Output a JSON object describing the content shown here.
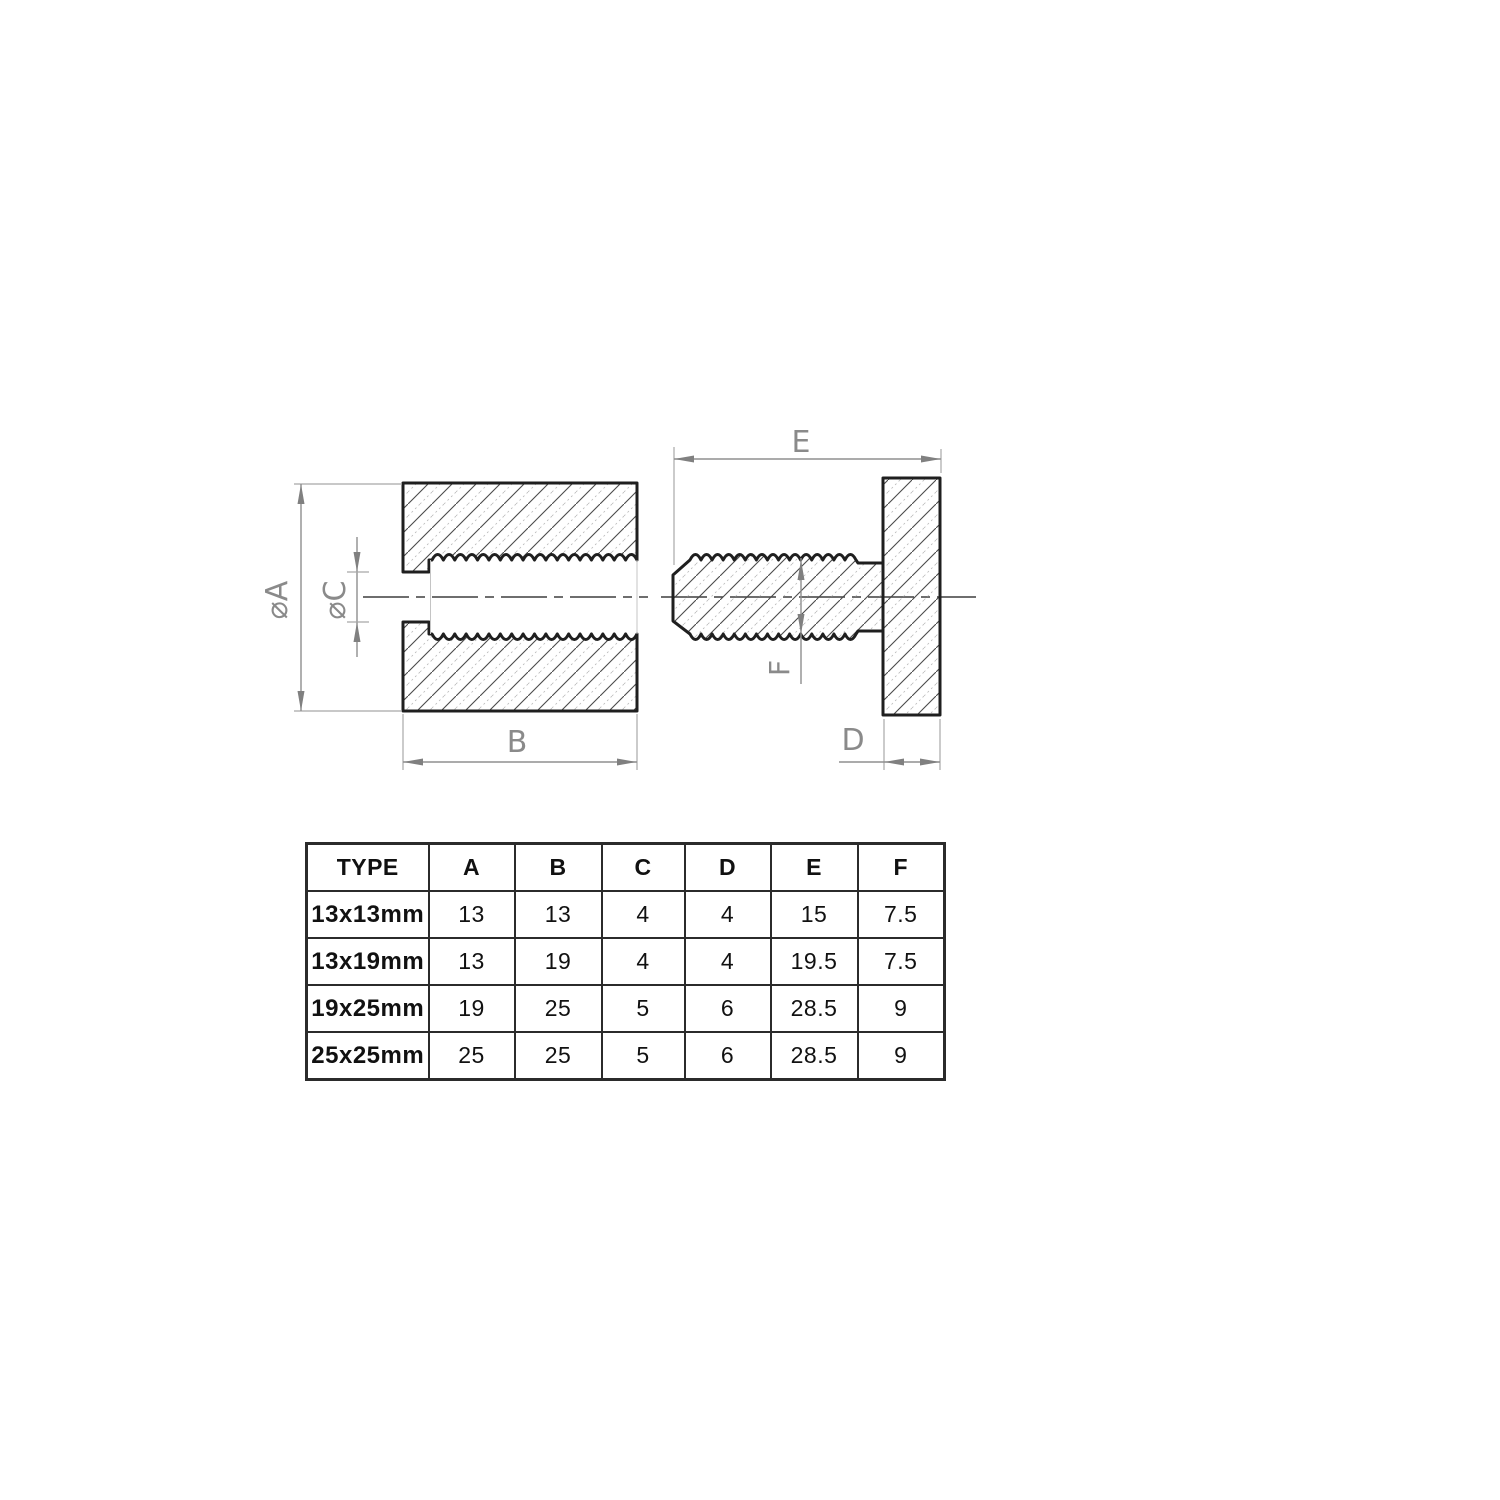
{
  "drawing": {
    "title": "threaded-sleeve-and-screw-section-drawing",
    "labels": {
      "phi_a": "⌀A",
      "phi_c": "⌀C",
      "b": "B",
      "e": "E",
      "f": "F",
      "d": "D"
    },
    "colors": {
      "outline": "#1f1f1f",
      "hatch": "#4a4a4a",
      "hatch_light": "#b9b9b9",
      "dimension": "#8f8f8f",
      "extension": "#a8a8a8",
      "centerline": "#3f3f3f",
      "table_border": "#2b2b2b",
      "table_text": "#111111"
    }
  },
  "table": {
    "headers": [
      "TYPE",
      "A",
      "B",
      "C",
      "D",
      "E",
      "F"
    ],
    "rows": [
      [
        "13x13mm",
        "13",
        "13",
        "4",
        "4",
        "15",
        "7.5"
      ],
      [
        "13x19mm",
        "13",
        "19",
        "4",
        "4",
        "19.5",
        "7.5"
      ],
      [
        "19x25mm",
        "19",
        "25",
        "5",
        "6",
        "28.5",
        "9"
      ],
      [
        "25x25mm",
        "25",
        "25",
        "5",
        "6",
        "28.5",
        "9"
      ]
    ]
  }
}
